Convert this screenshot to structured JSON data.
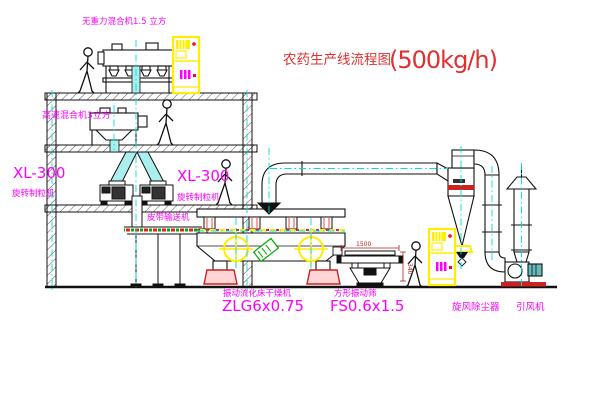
{
  "title": {
    "text_zh": "农药生产线流程图",
    "capacity": "(500kg/h)"
  },
  "equipment_labels": {
    "gravity_mixer": "无重力混合机1.5 立方",
    "high_speed_mixer": "高速混合机3立方",
    "granulator_left": {
      "model": "XL-300",
      "name": "旋转制粒机"
    },
    "granulator_center": {
      "model": "XL-300",
      "name": "旋转制粒机"
    },
    "belt_conveyor": "皮带输送机",
    "fluid_bed_dryer": {
      "name": "振动流化床干燥机",
      "model": "ZLG6x0.75"
    },
    "square_sieve": {
      "name": "方形振动筛",
      "model": "FS0.6x1.5"
    },
    "cyclone": "旋风除尘器",
    "draft_fan": "引风机"
  },
  "dimensions": {
    "sieve_length": "1500",
    "sieve_height": "340"
  },
  "colors": {
    "label_magenta": "#ff00ff",
    "title_red": "#e03030",
    "equipment_yellow": "#ffff00",
    "pipe_cyan": "#00dddd",
    "dim_red": "#b22222"
  }
}
